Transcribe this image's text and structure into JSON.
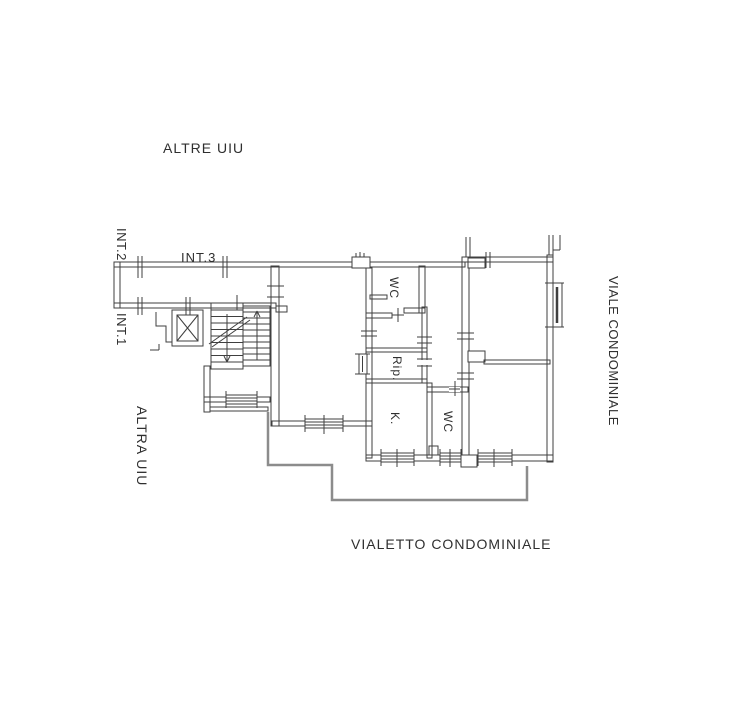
{
  "title": "Planimetria catastale (floor plan)",
  "labels": {
    "altre_uiu": "ALTRE UIU",
    "int2": "INT.2",
    "int3": "INT.3",
    "int1": "INT.1",
    "altra_uiu": "ALTRA UIU",
    "viale": "VIALE CONDOMINIALE",
    "vialetto": "VIALETTO CONDOMINIALE"
  },
  "rooms": {
    "wc_top": "WC",
    "rip": "Rip.",
    "k": "K.",
    "wc_bottom": "WC"
  },
  "plan_features": {
    "common_areas": [
      "corridor",
      "elevator-shaft",
      "staircase",
      "stair-landing"
    ],
    "apartment_rooms": [
      "wc",
      "rip",
      "kitchen",
      "wc",
      "living-room",
      "bedroom-top-right",
      "bedroom-bottom-right",
      "hall"
    ],
    "exterior": [
      "viale-condominiale (right)",
      "vialetto-condominiale (bottom path)"
    ]
  },
  "colors": {
    "background": "#ffffff",
    "wall_line": "#3f3f3f",
    "courtyard_boundary": "#8c8c8c",
    "text": "#2f2f2f"
  }
}
